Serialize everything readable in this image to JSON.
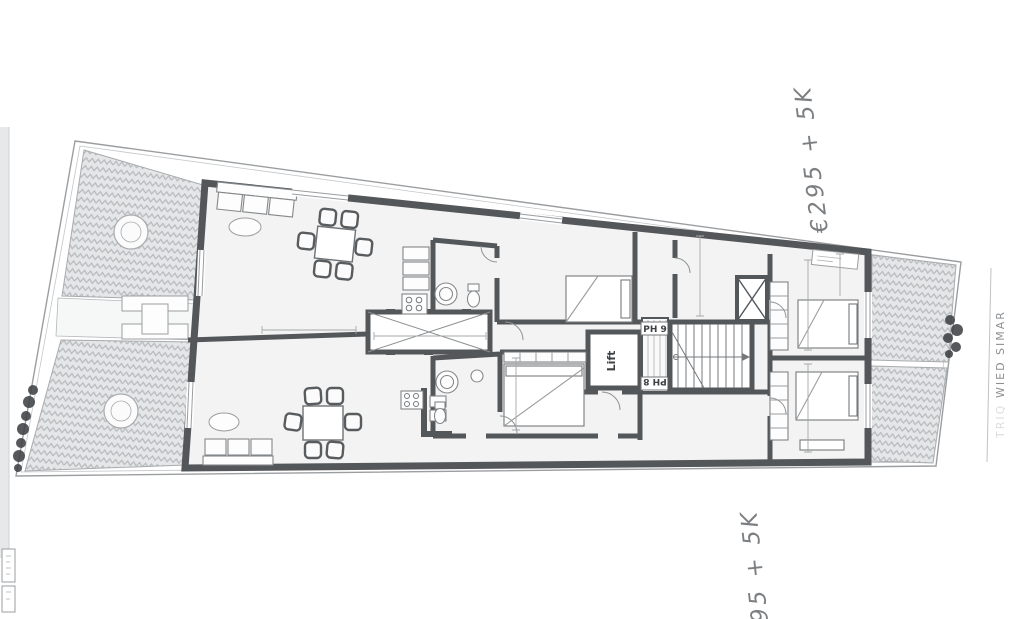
{
  "plan": {
    "unit_label_top": "PH 9",
    "unit_label_bottom": "PH 8",
    "lift_label": "Lift",
    "street_prefix": "TRIQ",
    "street_name": "WIED SIMAR"
  },
  "annotations": {
    "top_right": "€295 + 5K",
    "bottom": "95 + 5K"
  },
  "colors": {
    "wall": "#54575a",
    "paper": "#ffffff",
    "room_fill": "#f2f3f2",
    "terrace_fill": "#e4e6e7",
    "herringbone_stroke": "#b6babc",
    "thin_line": "#8b8e91",
    "boundary_line": "#9b9ea1",
    "handwriting": "#66696d",
    "plant": "#3f4245",
    "scan_strip": "#e7e8e9"
  }
}
